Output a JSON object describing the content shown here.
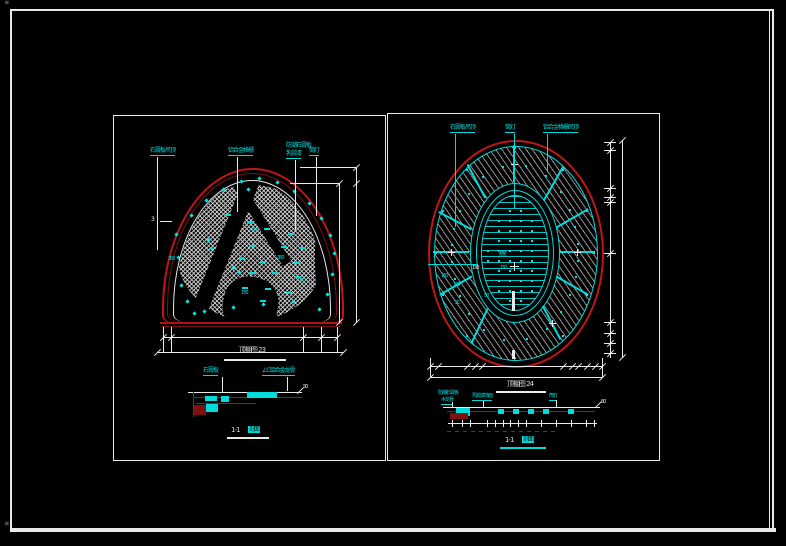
{
  "frame": {
    "corner_mark_top": "✳",
    "corner_mark_bottom": "✳"
  },
  "colors": {
    "background": "#000000",
    "frame_white": "#e9e9e9",
    "outline_red": "#c01616",
    "dark_red": "#7d1010",
    "annotation_cyan": "#00dcdc"
  },
  "left_drawing": {
    "caption": "顶棚图 23",
    "top_labels": [
      "石膏板吊顶",
      "铝合金格栅",
      "防潮石膏板",
      "乳胶漆",
      "筒灯"
    ],
    "side_tick_label": "3",
    "side_label": "350",
    "inner_labels": [
      "150",
      "350",
      "150",
      "750"
    ]
  },
  "left_section": {
    "labels": [
      "石膏板",
      "∠C铝合金龙骨"
    ],
    "dim_label": "50",
    "caption_num": "1-1",
    "caption_word": "剖面"
  },
  "right_drawing": {
    "caption": "顶棚图 24",
    "top_labels": [
      "石膏板吊顶",
      "筒灯",
      "铝合金格栅吊顶"
    ],
    "inner_labels": [
      "150",
      "150",
      "150",
      "150",
      "138",
      "50",
      "2C"
    ]
  },
  "right_section": {
    "labels": [
      "防潮石膏板",
      "木龙骨",
      "乳胶漆饰面",
      "筒灯"
    ],
    "dim_label": "50",
    "caption_num": "1-1",
    "caption_word": "剖面"
  }
}
